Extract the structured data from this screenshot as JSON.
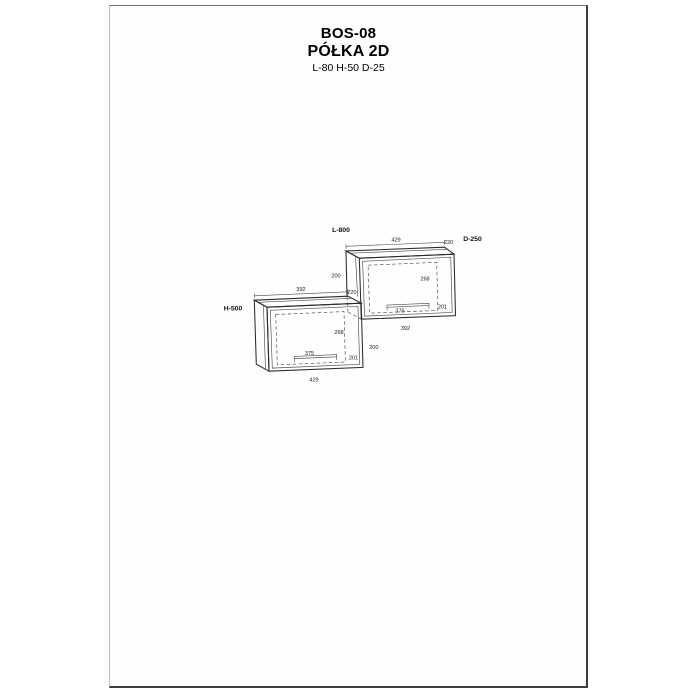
{
  "header": {
    "code": "BOS-08",
    "name": "PÓŁKA 2D",
    "size": "L-80 H-50 D-25"
  },
  "drawing": {
    "labels": {
      "length": "L-800",
      "depth": "D-250",
      "height": "H-500"
    },
    "right_unit": {
      "top_width": "429",
      "top_depth": "220",
      "side_upper": "200",
      "side_lower": "220",
      "door_height": "268",
      "handle_width": "375",
      "door_bottom": "201",
      "bottom_width": "392"
    },
    "left_unit": {
      "top_width": "392",
      "door_height": "268",
      "handle_width": "375",
      "door_bottom": "201",
      "side_lower": "200",
      "bottom_width": "429"
    }
  }
}
